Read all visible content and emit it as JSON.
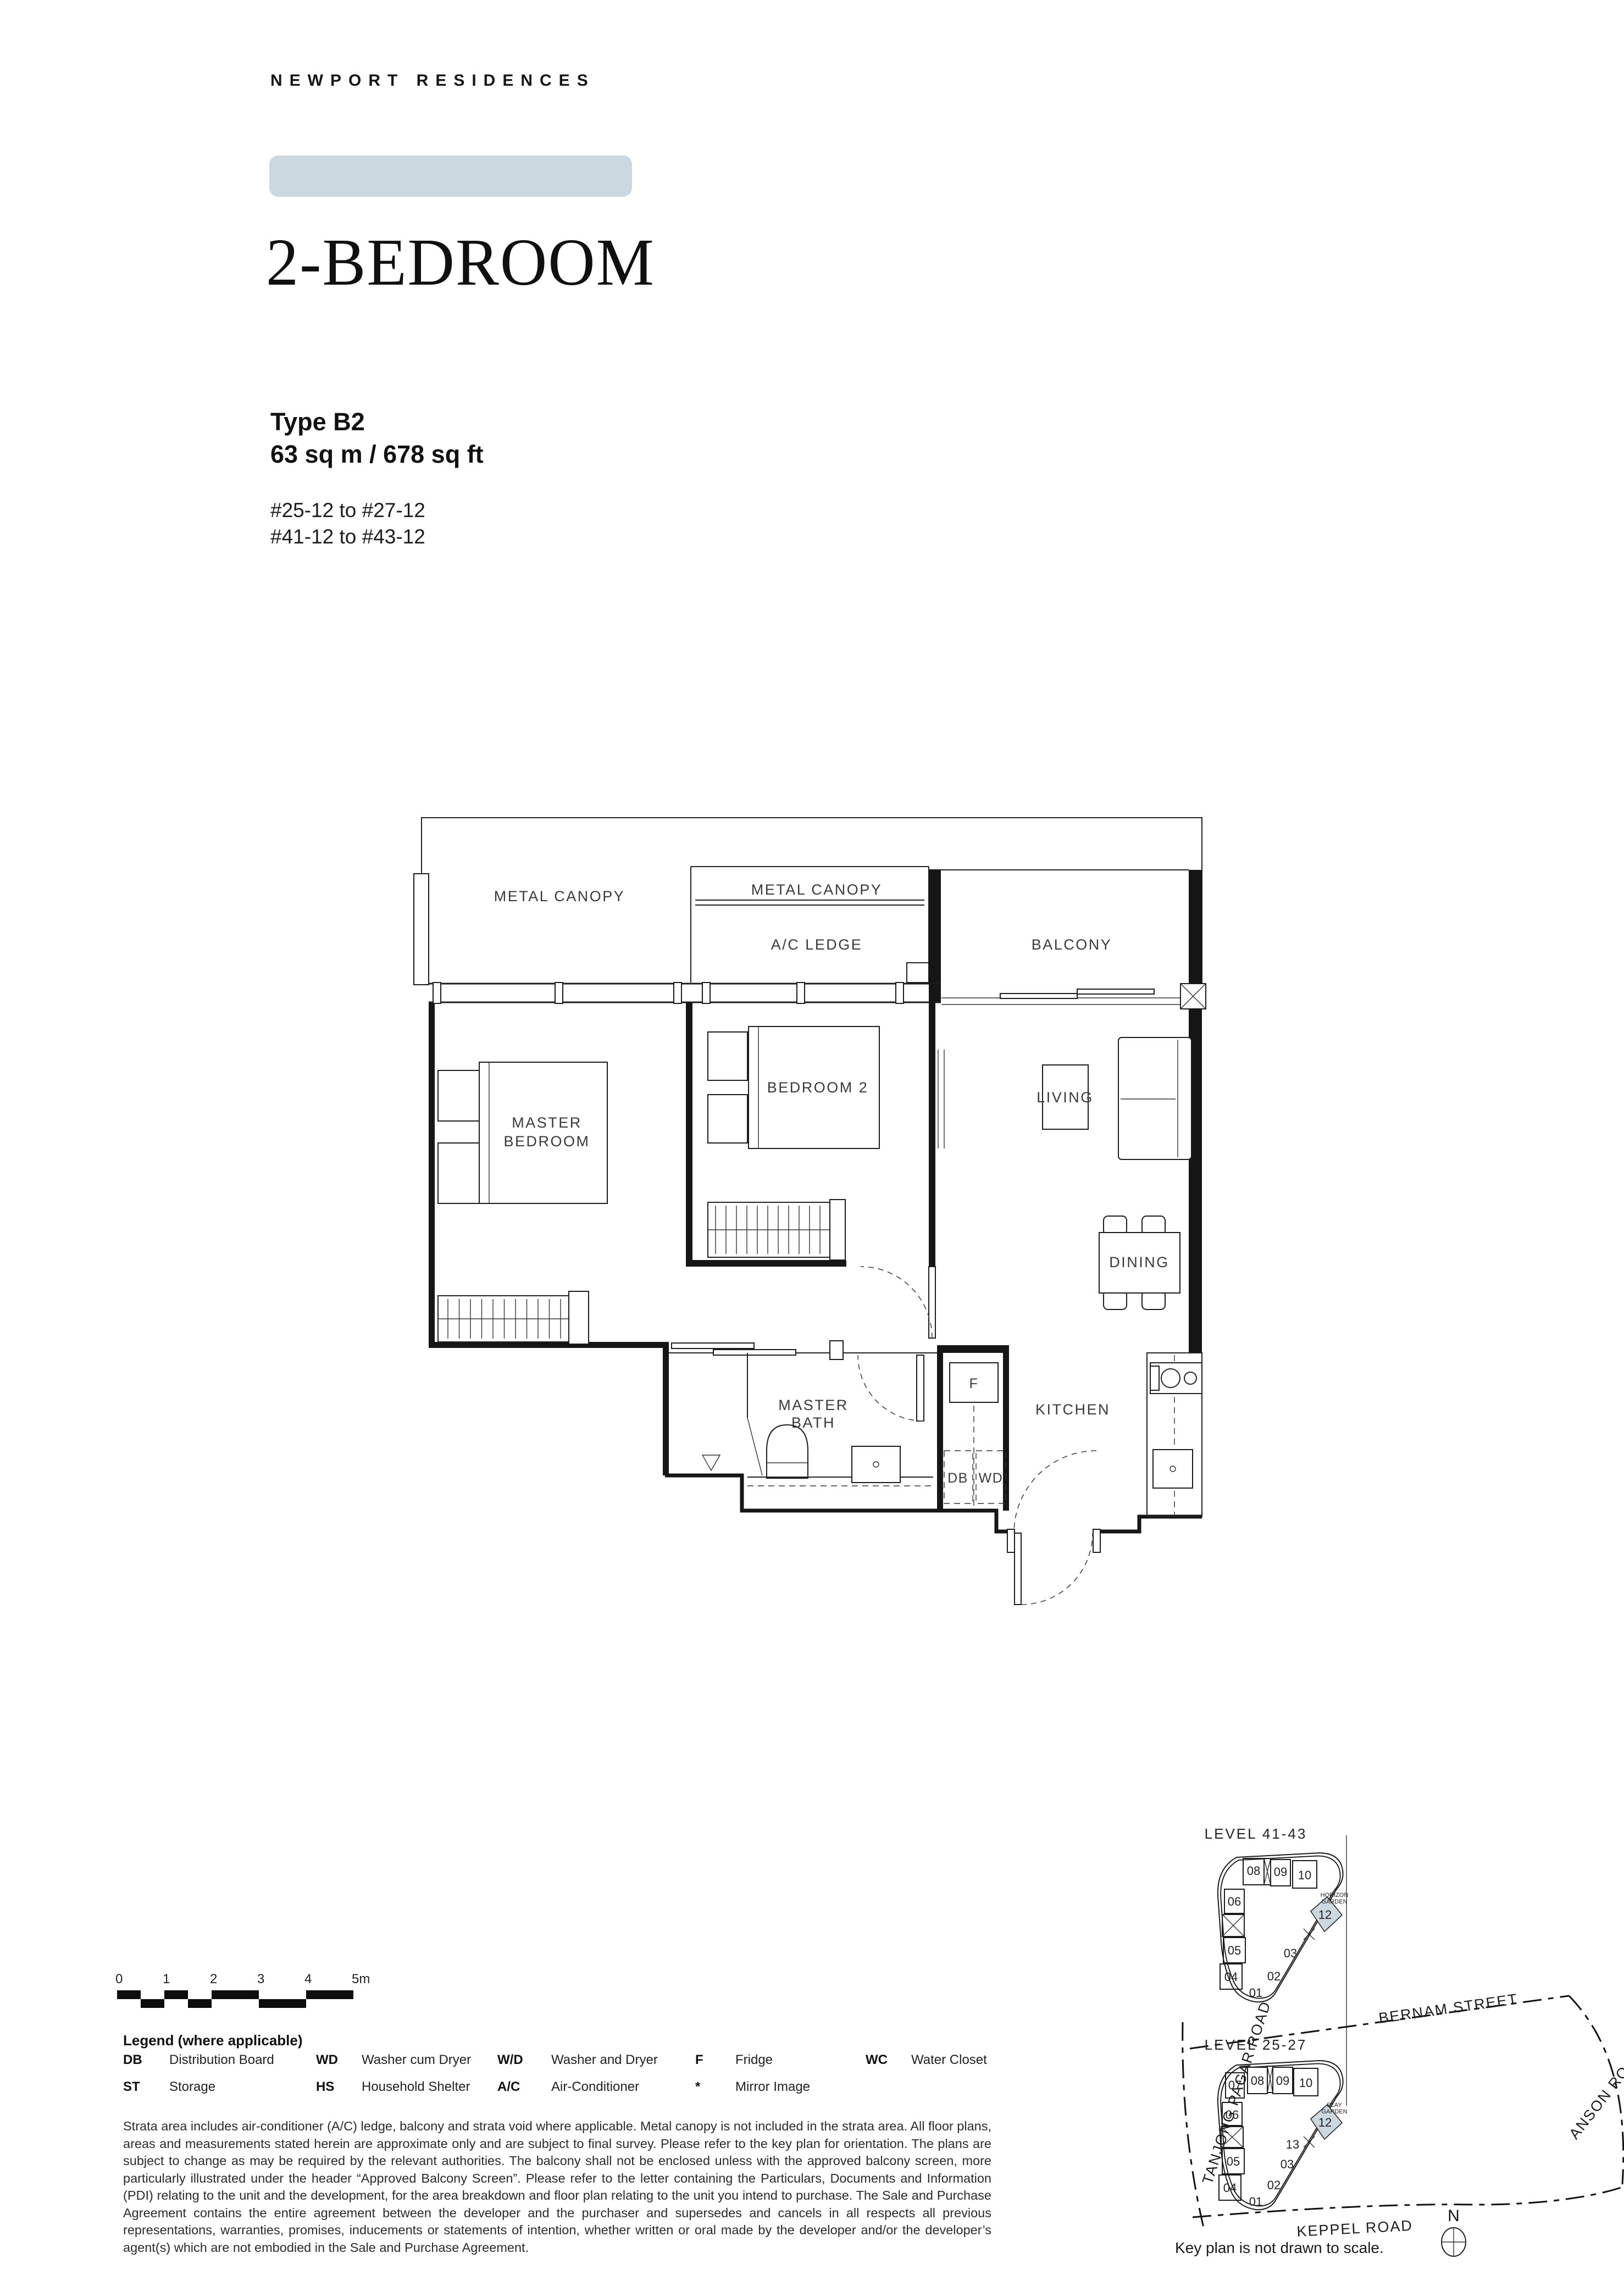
{
  "header": {
    "brand": "NEWPORT RESIDENCES",
    "title": "2-BEDROOM",
    "unit_type": "Type B2",
    "area": "63 sq m / 678 sq ft",
    "stack_line_1": "#25-12 to #27-12",
    "stack_line_2": "#41-12 to #43-12"
  },
  "floor_plan": {
    "labels": {
      "metal_canopy_left": "METAL CANOPY",
      "metal_canopy_mid": "METAL CANOPY",
      "ac_ledge": "A/C LEDGE",
      "balcony": "BALCONY",
      "master_bedroom_1": "MASTER",
      "master_bedroom_2": "BEDROOM",
      "bedroom2": "BEDROOM 2",
      "living": "LIVING",
      "dining": "DINING",
      "master_bath_1": "MASTER",
      "master_bath_2": "BATH",
      "kitchen": "KITCHEN",
      "fridge": "F",
      "db": "DB",
      "wd": "WD"
    }
  },
  "scale_bar": {
    "ticks": [
      "0",
      "1",
      "2",
      "3",
      "4",
      "5m"
    ]
  },
  "legend": {
    "title": "Legend (where applicable)",
    "items": [
      {
        "abbr": "DB",
        "label": "Distribution Board"
      },
      {
        "abbr": "ST",
        "label": "Storage"
      },
      {
        "abbr": "WD",
        "label": "Washer cum Dryer"
      },
      {
        "abbr": "HS",
        "label": "Household Shelter"
      },
      {
        "abbr": "W/D",
        "label": "Washer and Dryer"
      },
      {
        "abbr": "A/C",
        "label": "Air-Conditioner"
      },
      {
        "abbr": "F",
        "label": "Fridge"
      },
      {
        "abbr": "*",
        "label": "Mirror Image"
      },
      {
        "abbr": "WC",
        "label": "Water Closet"
      }
    ]
  },
  "disclaimer": "Strata area includes air-conditioner (A/C) ledge, balcony and strata void where applicable. Metal canopy is not included in the strata area. All floor plans, areas and measurements stated herein are approximate only and are subject to final survey. Please refer to the key plan for orientation. The plans are subject to change as may be required by the relevant authorities. The balcony shall not be enclosed unless with the approved balcony screen, more particularly illustrated under the header “Approved Balcony Screen”. Please refer to the letter containing the Particulars, Documents and Information (PDI) relating to the unit and the development, for the area breakdown and floor plan relating to the unit you intend to purchase. The Sale and Purchase Agreement contains the entire agreement between the developer and the purchaser and supersedes and cancels in all respects all previous representations, warranties, promises, inducements or statements of intention, whether written or oral made by the developer and/or the developer’s agent(s) which are not embodied in the Sale and Purchase Agreement.",
  "key_plan": {
    "upper_level": "LEVEL  41-43",
    "lower_level": "LEVEL  25-27",
    "upper_units": [
      "08",
      "09",
      "10",
      "06",
      "05",
      "04",
      "01",
      "02",
      "03",
      "12"
    ],
    "lower_units": [
      "07",
      "08",
      "09",
      "10",
      "06",
      "05",
      "04",
      "01",
      "02",
      "03",
      "13",
      "12"
    ],
    "upper_garden": "HORIZON GARDEN",
    "lower_garden": "PLAY GARDEN",
    "roads": {
      "bernam": "BERNAM STREET",
      "tanjong": "TANJONG PAGAR ROAD",
      "anson": "ANSON ROAD",
      "keppel": "KEPPEL ROAD"
    },
    "note": "Key plan is not drawn to scale.",
    "compass_n": "N",
    "highlight_unit": "12",
    "highlight_color": "#cbd8e0"
  },
  "colors": {
    "accent_bar": "#cbd8e0",
    "line": "#1c1c1c"
  }
}
